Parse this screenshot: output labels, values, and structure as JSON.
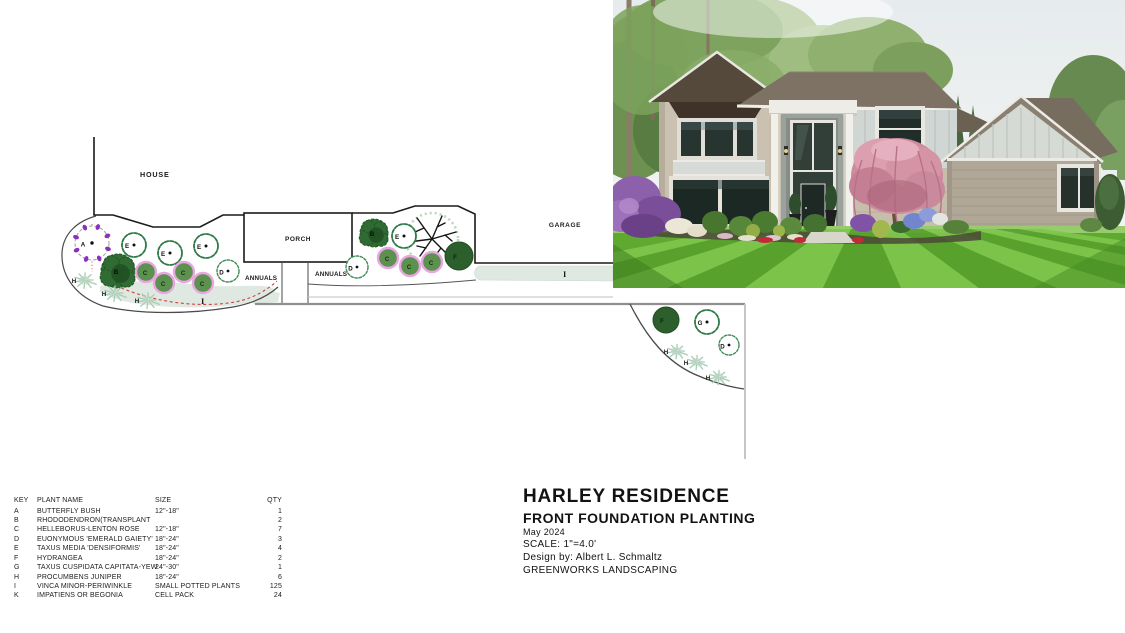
{
  "title_block": {
    "residence": "HARLEY RESIDENCE",
    "subtitle": "FRONT FOUNDATION PLANTING",
    "date": "May 2024",
    "scale": "SCALE: 1\"=4.0'",
    "designer": "Design by:  Albert L. Schmaltz",
    "company": "GREENWORKS LANDSCAPING"
  },
  "key_table": {
    "headers": [
      "KEY",
      "PLANT NAME",
      "SIZE",
      "QTY"
    ],
    "rows": [
      {
        "key": "A",
        "name": "BUTTERFLY BUSH",
        "size": "12\"-18\"",
        "qty": "1"
      },
      {
        "key": "B",
        "name": "RHODODENDRON(TRANSPLANT",
        "size": "",
        "qty": "2"
      },
      {
        "key": "C",
        "name": "HELLEBORUS-LENTON ROSE",
        "size": "12\"-18\"",
        "qty": "7"
      },
      {
        "key": "D",
        "name": "EUONYMOUS 'EMERALD GAIETY'",
        "size": "18\"-24\"",
        "qty": "3"
      },
      {
        "key": "E",
        "name": "TAXUS MEDIA 'DENSIFORMIS'",
        "size": "18\"-24\"",
        "qty": "4"
      },
      {
        "key": "F",
        "name": "HYDRANGEA",
        "size": "18\"-24\"",
        "qty": "2"
      },
      {
        "key": "G",
        "name": "TAXUS CUSPIDATA CAPITATA-YEW",
        "size": "24\"-30\"",
        "qty": "1"
      },
      {
        "key": "H",
        "name": "PROCUMBENS JUNIPER",
        "size": "18\"-24\"",
        "qty": "6"
      },
      {
        "key": "I",
        "name": "VINCA MINOR-PERIWINKLE",
        "size": "SMALL POTTED PLANTS",
        "qty": "125"
      },
      {
        "key": "K",
        "name": "IMPATIENS OR BEGONIA",
        "size": "CELL PACK",
        "qty": "24"
      }
    ]
  },
  "plan": {
    "labels": {
      "house": "HOUSE",
      "porch": "PORCH",
      "garage": "GARAGE",
      "annuals_left": "ANNUALS",
      "annuals_right": "ANNUALS",
      "vinca_left": "I",
      "vinca_right": "I"
    },
    "plants": [
      {
        "key": "A",
        "type": "flower-ring",
        "x": 92,
        "y": 243,
        "r": 17
      },
      {
        "key": "E",
        "type": "scallop",
        "x": 134,
        "y": 245,
        "r": 12
      },
      {
        "key": "E",
        "type": "scallop",
        "x": 170,
        "y": 253,
        "r": 12
      },
      {
        "key": "E",
        "type": "scallop",
        "x": 206,
        "y": 246,
        "r": 12
      },
      {
        "key": "B",
        "type": "blob",
        "x": 118,
        "y": 271,
        "r": 17
      },
      {
        "key": "C",
        "type": "filled",
        "x": 146,
        "y": 272,
        "r": 10
      },
      {
        "key": "C",
        "type": "filled",
        "x": 164,
        "y": 283,
        "r": 10
      },
      {
        "key": "C",
        "type": "filled",
        "x": 184,
        "y": 272,
        "r": 10
      },
      {
        "key": "C",
        "type": "filled",
        "x": 203,
        "y": 283,
        "r": 10
      },
      {
        "key": "D",
        "type": "scallop-sm",
        "x": 228,
        "y": 271,
        "r": 11
      },
      {
        "key": "H",
        "type": "juniper",
        "x": 85,
        "y": 280,
        "r": 13
      },
      {
        "key": "H",
        "type": "juniper",
        "x": 115,
        "y": 293,
        "r": 13
      },
      {
        "key": "H",
        "type": "juniper",
        "x": 148,
        "y": 300,
        "r": 13
      },
      {
        "key": "B",
        "type": "blob",
        "x": 374,
        "y": 233,
        "r": 14
      },
      {
        "key": "E",
        "type": "scallop",
        "x": 404,
        "y": 236,
        "r": 12
      },
      {
        "key": "D",
        "type": "scallop-sm",
        "x": 357,
        "y": 267,
        "r": 11
      },
      {
        "key": "C",
        "type": "filled",
        "x": 388,
        "y": 258,
        "r": 10
      },
      {
        "key": "C",
        "type": "filled",
        "x": 410,
        "y": 266,
        "r": 10
      },
      {
        "key": "C",
        "type": "filled",
        "x": 432,
        "y": 262,
        "r": 10
      },
      {
        "key": "F",
        "type": "dark",
        "x": 459,
        "y": 256,
        "r": 14
      },
      {
        "key": "F",
        "type": "dark",
        "x": 666,
        "y": 320,
        "r": 13
      },
      {
        "key": "G",
        "type": "scallop",
        "x": 707,
        "y": 322,
        "r": 12
      },
      {
        "key": "D",
        "type": "scallop-sm",
        "x": 729,
        "y": 345,
        "r": 10
      },
      {
        "key": "H",
        "type": "juniper",
        "x": 677,
        "y": 351,
        "r": 12
      },
      {
        "key": "H",
        "type": "juniper",
        "x": 697,
        "y": 362,
        "r": 12
      },
      {
        "key": "H",
        "type": "juniper",
        "x": 719,
        "y": 377,
        "r": 12
      }
    ],
    "palette": {
      "c_fill": "#5d9150",
      "c_stroke": "#e9a6e3",
      "blob_fill": "#2f6b33",
      "blob_dark": "#1e4d22",
      "dark_fill": "#2c5f2c",
      "scallop_stroke": "#2c7a45",
      "scallop_sm_stroke": "#3f8c58",
      "vinca_fill": "#dfe9e1",
      "juniper_stroke": "#a9ccb5",
      "petal_purple": "#8b2fc0",
      "dashed_red": "#cc4444",
      "wall_line": "#1a1a1a",
      "bed_line": "#4a4a4a",
      "walk_gray": "#8f8f8f"
    }
  }
}
